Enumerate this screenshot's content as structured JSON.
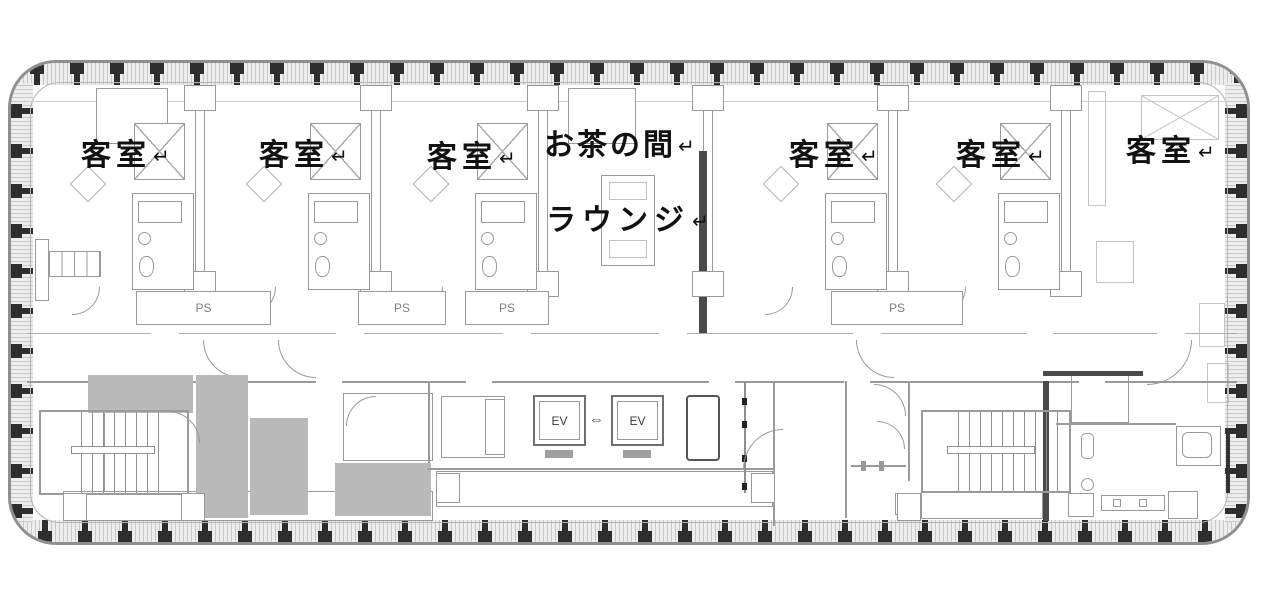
{
  "plan": {
    "labels": {
      "guest_room": "客室",
      "tea_room": "お茶の間",
      "lounge": "ラウンジ",
      "pipe_shaft": "PS",
      "elevator": "EV",
      "return_arrow": "↵",
      "elevator_door_arrows": "⇔"
    },
    "counts": {
      "guest_rooms": 6,
      "pipe_shafts": 4,
      "elevators": 2,
      "stairwells": 2
    },
    "colors": {
      "background": "#ffffff",
      "wall": "#9a9a9a",
      "dark_wall": "#4a4a4a",
      "shaft_fill": "#b9b9b9",
      "facade_band": "#ededed",
      "mullion": "#2e2e2e",
      "label_text": "#111111"
    }
  }
}
